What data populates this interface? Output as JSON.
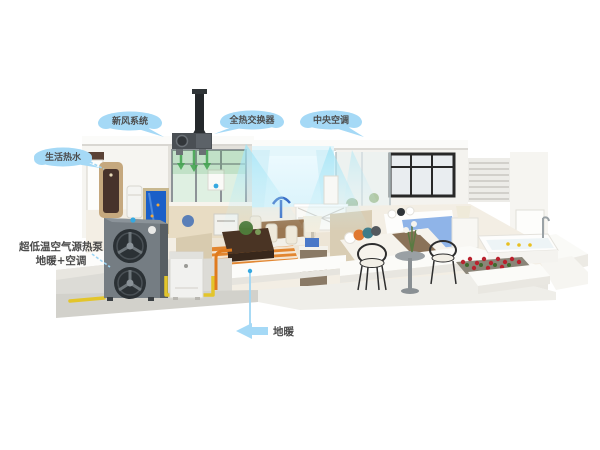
{
  "scene_title": "whole-house heat pump system cutaway illustration",
  "callouts": {
    "top_left": {
      "label": "新风系统"
    },
    "top_center": {
      "label": "全热交换器"
    },
    "top_right": {
      "label": "中央空调"
    },
    "water_heater": {
      "label": "生活热水"
    },
    "outdoor_unit": {
      "line1": "超低温空气源热泵",
      "line2": "地暖+空调"
    },
    "floor_heating": {
      "label": "地暖"
    }
  },
  "colors": {
    "callout_bubble": "#A5D9F6",
    "callout_text": "#4D4D4D",
    "leader_line": "#9FD6F4",
    "marker_dot": "#35A8E0",
    "heat_pump_body": "#757D83",
    "heat_pump_side": "#575E63",
    "fan_housing": "#2B3135",
    "hydronic_box": "#F1F1EF",
    "pipe_yellow": "#E3C52B",
    "floor_coil_orange": "#E07B1E",
    "airflow_cyan": "#9FE4F6",
    "airflow_green": "#3FA34D",
    "water_heater_gold": "#C5A87E",
    "water_heater_panel": "#47322B",
    "aquarium_blue": "#1A5FC8",
    "bed_blanket_blue": "#8FB4E8",
    "flowers_red": "#B9222E",
    "platform_gray": "#DCDBD6",
    "floor_cream": "#F3EEE4"
  }
}
